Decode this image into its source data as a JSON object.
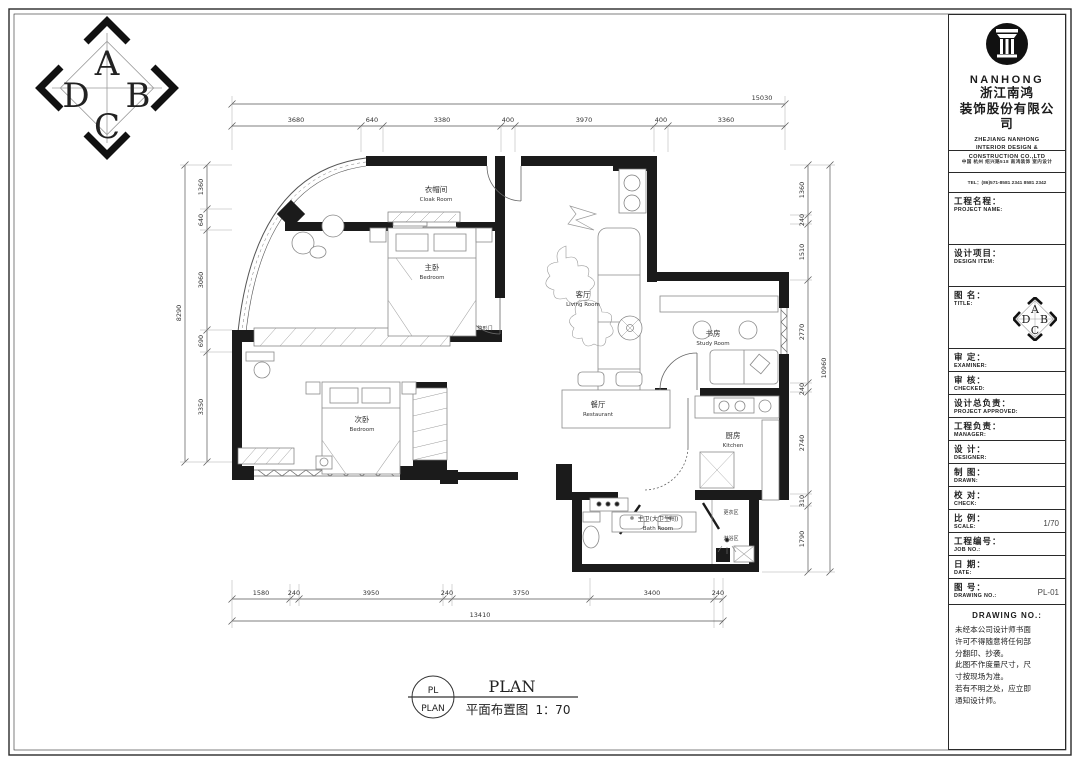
{
  "corner_logo": {
    "letters": [
      "A",
      "B",
      "C",
      "D"
    ]
  },
  "title_block": {
    "brand": "NANHONG",
    "company_cn_1": "浙江南鸿",
    "company_cn_2": "装饰股份有限公司",
    "company_en_1": "ZHEJIANG NANHONG",
    "company_en_2": "INTERIOR DESIGN &",
    "company_en_3": "CONSTRUCTION CO.,LTD",
    "address": "中国  杭州  绍兴路518  南鸿装饰  室内设计",
    "tel": "TEL：(86)571-8581 2341  8581 2342",
    "fields": [
      {
        "cn": "工程名程：",
        "en": "PROJECT NAME:",
        "value": ""
      },
      {
        "cn": "设计项目：",
        "en": "DESIGN ITEM:",
        "value": ""
      },
      {
        "cn": "图  名：",
        "en": "TITLE:",
        "value": ""
      },
      {
        "cn": "审  定：",
        "en": "EXAMINER:",
        "value": ""
      },
      {
        "cn": "审  核：",
        "en": "CHECKED:",
        "value": ""
      },
      {
        "cn": "设计总负责：",
        "en": "PROJECT APPROVED:",
        "value": ""
      },
      {
        "cn": "工程负责：",
        "en": "MANAGER:",
        "value": ""
      },
      {
        "cn": "设  计：",
        "en": "DESIGNER:",
        "value": ""
      },
      {
        "cn": "制  图：",
        "en": "DRAWN:",
        "value": ""
      },
      {
        "cn": "校  对：",
        "en": "CHECK:",
        "value": ""
      },
      {
        "cn": "比  例：",
        "en": "SCALE:",
        "value": "1/70"
      },
      {
        "cn": "工程编号：",
        "en": "JOB NO.:",
        "value": ""
      },
      {
        "cn": "日  期：",
        "en": "DATE:",
        "value": ""
      },
      {
        "cn": "图  号：",
        "en": "DRAWING NO.:",
        "value": "PL-01"
      }
    ],
    "notes_title": "DRAWING NO.:",
    "notes": [
      "未经本公司设计师书面",
      "许可不得随意将任何部",
      "分翻印、抄袭。",
      "此图不作度量尺寸，尺",
      "寸按现场为准。",
      "若有不明之处，应立即",
      "通知设计师。"
    ]
  },
  "plan": {
    "rooms": [
      {
        "cn": "衣帽间",
        "en": "Cloak  Room"
      },
      {
        "cn": "主卧",
        "en": "Bedroom"
      },
      {
        "cn": "客厅",
        "en": "Living Room"
      },
      {
        "cn": "书房",
        "en": "Study  Room"
      },
      {
        "cn": "次卧",
        "en": "Bedroom"
      },
      {
        "cn": "餐厅",
        "en": "Restaurant"
      },
      {
        "cn": "厨房",
        "en": "Kitchen"
      },
      {
        "cn": "主卫(大卫生间)",
        "en": "Bath  Room"
      },
      {
        "cn": "更衣区",
        "en": ""
      },
      {
        "cn": "淋浴区",
        "en": ""
      },
      {
        "cn": "隐形门",
        "en": ""
      }
    ],
    "dims": {
      "top_total": "15030",
      "top": [
        "3680",
        "640",
        "3380",
        "400",
        "3970",
        "400",
        "3360"
      ],
      "bottom": [
        "1580",
        "240",
        "3950",
        "240",
        "3750",
        "3400",
        "240"
      ],
      "bottom_total": "13410",
      "left_total": "8290",
      "left": [
        "1360",
        "640",
        "3060",
        "690",
        "3350"
      ],
      "right_total": "10960",
      "right": [
        "1360",
        "240",
        "1510",
        "2770",
        "240",
        "2740",
        "310",
        "1790"
      ]
    }
  },
  "footer": {
    "symbol_top": "PL",
    "symbol_bottom": "PLAN",
    "title_en": "PLAN",
    "title_cn": "平面布置图",
    "scale": "1：70"
  }
}
